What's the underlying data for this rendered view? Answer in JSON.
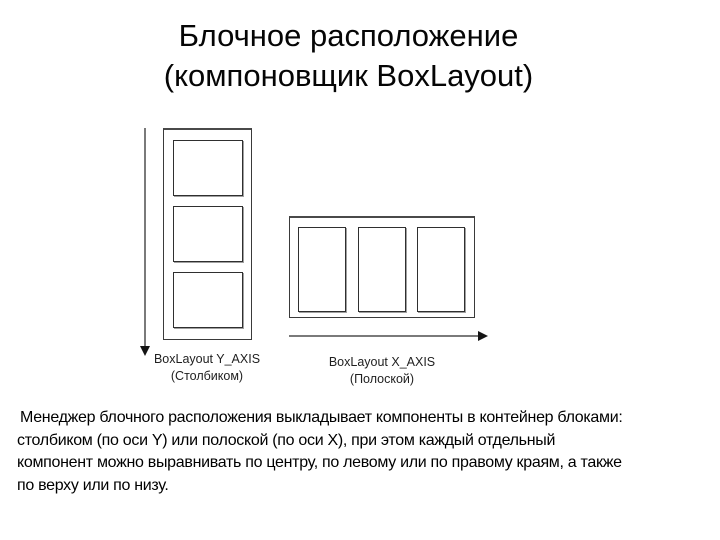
{
  "slide": {
    "title_lines": [
      "Блочное расположение",
      "(компоновщик BoxLayout)"
    ],
    "description_lines": [
      "Менеджер блочного расположения выкладывает компоненты в контейнер блоками:",
      "столбиком (по оси Y) или полоской (по оси X), при этом каждый отдельный",
      "компонент можно выравнивать по центру, по левому или по правому краям, а также",
      "по верху или по низу."
    ]
  },
  "diagrams": {
    "y_axis": {
      "orientation": "vertical",
      "component_count": 3,
      "label": "BoxLayout Y_AXIS",
      "sublabel": "(Столбиком)"
    },
    "x_axis": {
      "orientation": "horizontal",
      "component_count": 3,
      "label": "BoxLayout X_AXIS",
      "sublabel": "(Полоской)"
    }
  },
  "colors": {
    "background": "#ffffff",
    "text": "#000000",
    "container_border": "#3a3a3a",
    "component_border": "#2f2f2f",
    "component_shadow": "#a0a0a0",
    "arrow_line": "#7a7a7a",
    "arrow_head": "#141414",
    "label_text": "#1f1f1f"
  }
}
